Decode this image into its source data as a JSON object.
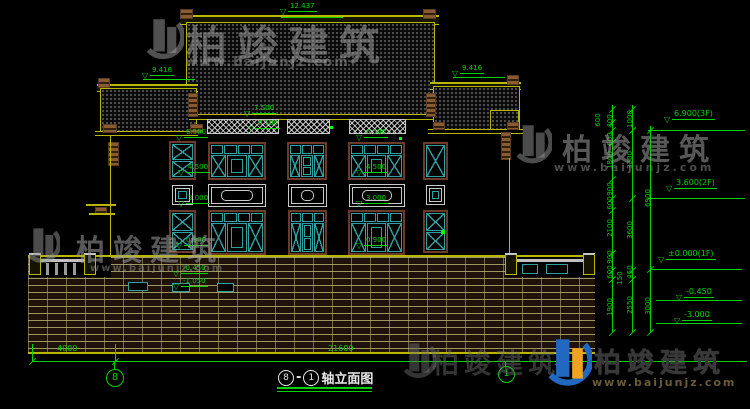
{
  "watermark": {
    "brand": "柏竣建筑",
    "url": "www.baijunjz.com"
  },
  "title": {
    "axis_from": "8",
    "separator": "-",
    "axis_to": "1",
    "text": "轴立面图"
  },
  "axis_bubbles": {
    "left": "8",
    "right": "1"
  },
  "dims_bottom": {
    "left_bay": "4000",
    "total": "21600"
  },
  "elevations": {
    "ridge": "12.437",
    "left_roof": "9.416",
    "right_roof": "9.416",
    "eave": "7.500",
    "band": "6.500",
    "left_col": [
      "6.500",
      "4.500",
      "3.000",
      "0.900"
    ],
    "mid_col": [
      "6.500",
      "4.500",
      "3.000",
      "0.900"
    ],
    "base": [
      "-0.450",
      "-1.050"
    ],
    "right_chain": [
      "6.900(3F)",
      "3.600(2F)",
      "±0.000(1F)",
      "-0.450",
      "-3.000"
    ]
  },
  "dims_right": {
    "col0": [
      "600"
    ],
    "col1": [
      "400",
      "600",
      "1800",
      "900",
      "600",
      "2100",
      "900",
      "600",
      "150",
      "1900"
    ],
    "col2": [
      "1000",
      "3300",
      "3600",
      "450",
      "2550"
    ],
    "col3": [
      "6900",
      "3000"
    ]
  },
  "colors": {
    "cad_green": "#00d400",
    "cad_yellow": "#b8b800",
    "window_teal": "#2fa0a0",
    "logo_blue": "#2268c0",
    "logo_orange": "#f0a225"
  }
}
